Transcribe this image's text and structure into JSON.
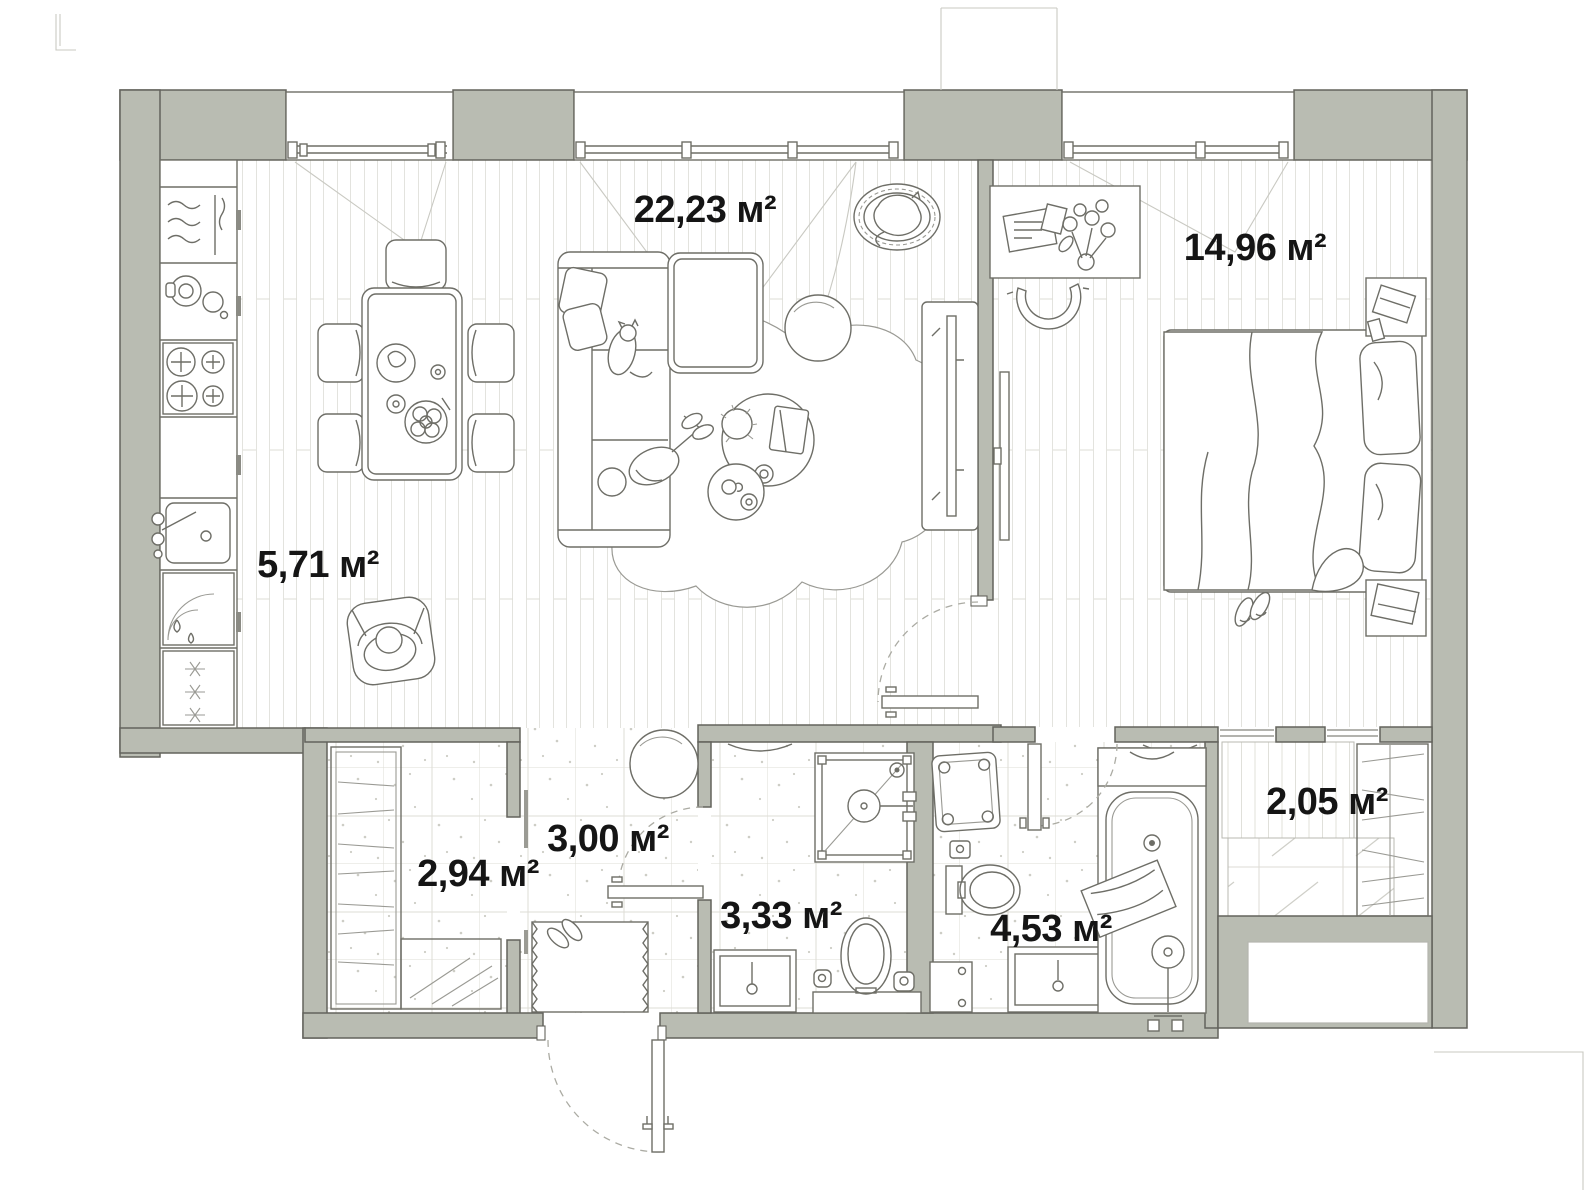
{
  "plan": {
    "type": "apartment-floor-plan",
    "area_unit": "м²",
    "rooms": [
      {
        "id": "living-dining-room",
        "area_label": "22,23 м²"
      },
      {
        "id": "bedroom",
        "area_label": "14,96 м²"
      },
      {
        "id": "kitchen-zone",
        "area_label": "5,71 м²"
      },
      {
        "id": "wardrobe",
        "area_label": "2,94 м²"
      },
      {
        "id": "hallway",
        "area_label": "3,00 м²"
      },
      {
        "id": "shower-room",
        "area_label": "3,33 м²"
      },
      {
        "id": "bathroom",
        "area_label": "4,53 м²"
      },
      {
        "id": "balcony",
        "area_label": "2,05 м²"
      }
    ],
    "colors": {
      "wall": "#b9bcb2",
      "wallline": "#63635c",
      "furn": "#6e6e67",
      "light": "#9a9a94",
      "artifact": "#c9c9c2",
      "dash": "#ababa3",
      "label": "#151515",
      "floorline": "#e3e3de",
      "tileline": "#dedcd5",
      "speckle": "#cdcdc5"
    }
  }
}
